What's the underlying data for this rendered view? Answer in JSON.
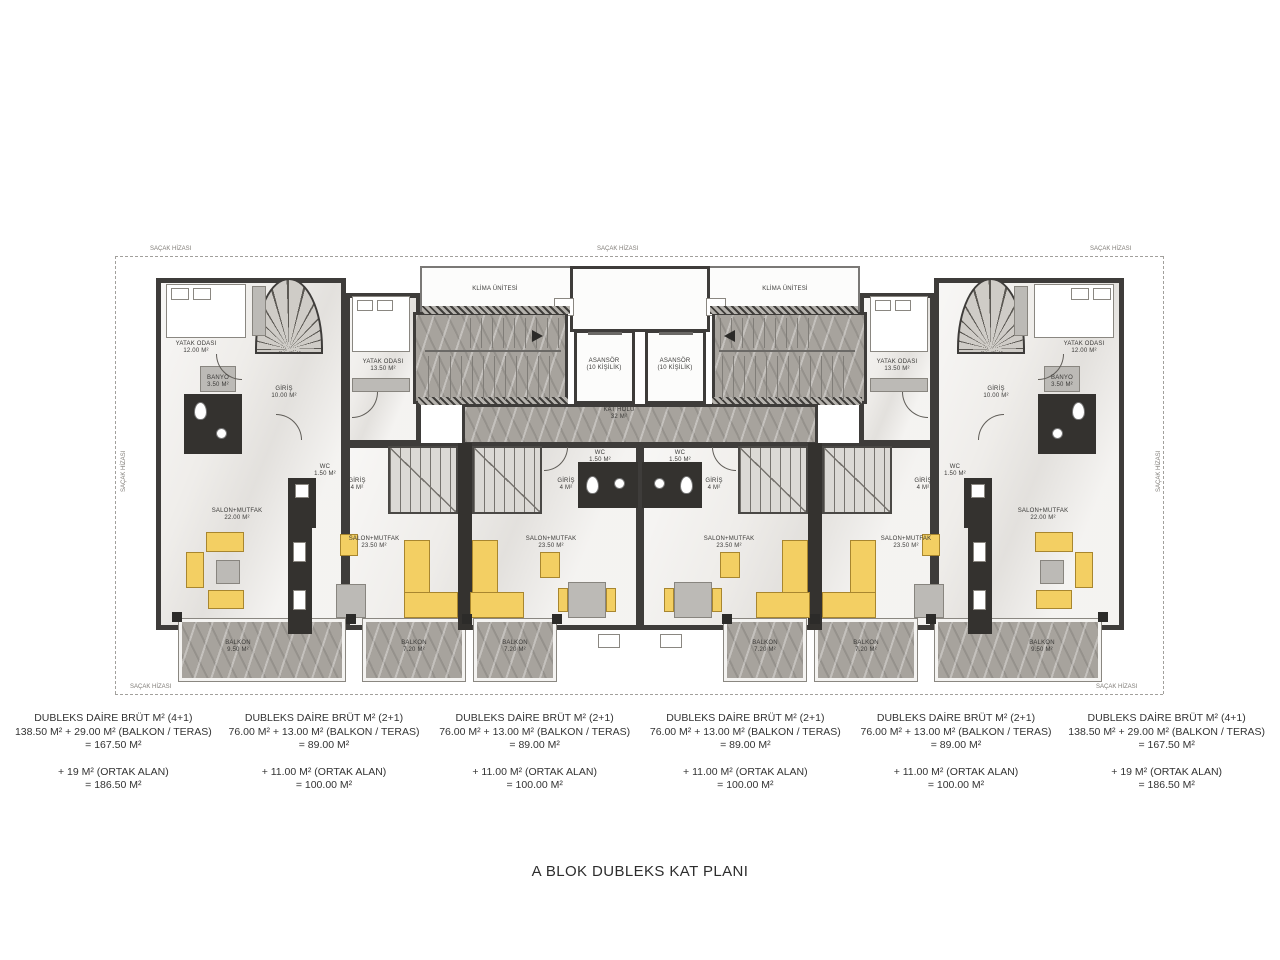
{
  "title": "A BLOK DUBLEKS KAT PLANI",
  "eave": {
    "label": "SAÇAK HİZASI",
    "positions": [
      {
        "x": 150,
        "y": 246,
        "rot": 0
      },
      {
        "x": 597,
        "y": 246,
        "rot": 0
      },
      {
        "x": 1090,
        "y": 246,
        "rot": 0
      },
      {
        "x": 121,
        "y": 492,
        "rot": -90
      },
      {
        "x": 1156,
        "y": 492,
        "rot": -90
      },
      {
        "x": 130,
        "y": 684,
        "rot": 0
      },
      {
        "x": 1096,
        "y": 684,
        "rot": 0
      }
    ]
  },
  "plan_labels": [
    {
      "id": "yatak-odasi-nw",
      "text": "YATAK ODASI",
      "sub": "12.00 M²",
      "x": 196,
      "y": 341
    },
    {
      "id": "yatak-odasi-2-left",
      "text": "YATAK ODASI",
      "sub": "13.50 M²",
      "x": 383,
      "y": 359
    },
    {
      "id": "banyo-left",
      "text": "BANYO",
      "sub": "3.50 M²",
      "x": 218,
      "y": 375
    },
    {
      "id": "giris-left",
      "text": "GİRİŞ",
      "sub": "10.00 M²",
      "x": 284,
      "y": 386
    },
    {
      "id": "klima-unitesi-left",
      "text": "KLİMA ÜNİTESİ",
      "sub": "",
      "x": 495,
      "y": 286
    },
    {
      "id": "klima-unitesi-right",
      "text": "KLİMA ÜNİTESİ",
      "sub": "",
      "x": 785,
      "y": 286
    },
    {
      "id": "asansor-left",
      "text": "ASANSÖR",
      "sub": "(10 KİŞİLİK)",
      "x": 604,
      "y": 358
    },
    {
      "id": "asansor-right",
      "text": "ASANSÖR",
      "sub": "(10 KİŞİLİK)",
      "x": 675,
      "y": 358
    },
    {
      "id": "kat-holu",
      "text": "KAT HOLÜ",
      "sub": "32 M²",
      "x": 619,
      "y": 407
    },
    {
      "id": "salon-unit1",
      "text": "SALON+MUTFAK",
      "sub": "22.00 M²",
      "x": 237,
      "y": 508
    },
    {
      "id": "salon-unit2",
      "text": "SALON+MUTFAK",
      "sub": "23.50 M²",
      "x": 374,
      "y": 536
    },
    {
      "id": "salon-unit3",
      "text": "SALON+MUTFAK",
      "sub": "23.50 M²",
      "x": 551,
      "y": 536
    },
    {
      "id": "salon-unit4",
      "text": "SALON+MUTFAK",
      "sub": "23.50 M²",
      "x": 729,
      "y": 536
    },
    {
      "id": "salon-unit5",
      "text": "SALON+MUTFAK",
      "sub": "23.50 M²",
      "x": 906,
      "y": 536
    },
    {
      "id": "salon-unit6",
      "text": "SALON+MUTFAK",
      "sub": "22.00 M²",
      "x": 1043,
      "y": 508
    },
    {
      "id": "giris-unit2",
      "text": "GİRİŞ",
      "sub": "4 M²",
      "x": 357,
      "y": 478
    },
    {
      "id": "giris-unit3",
      "text": "GİRİŞ",
      "sub": "4 M²",
      "x": 566,
      "y": 478
    },
    {
      "id": "giris-unit4",
      "text": "GİRİŞ",
      "sub": "4 M²",
      "x": 714,
      "y": 478
    },
    {
      "id": "giris-unit5",
      "text": "GİRİŞ",
      "sub": "4 M²",
      "x": 923,
      "y": 478
    },
    {
      "id": "wc-unit1",
      "text": "WC",
      "sub": "1.50 M²",
      "x": 325,
      "y": 464
    },
    {
      "id": "wc-unit3",
      "text": "WC",
      "sub": "1.50 M²",
      "x": 600,
      "y": 450
    },
    {
      "id": "wc-unit4",
      "text": "WC",
      "sub": "1.50 M²",
      "x": 680,
      "y": 450
    },
    {
      "id": "wc-unit6",
      "text": "WC",
      "sub": "1.50 M²",
      "x": 955,
      "y": 464
    },
    {
      "id": "yatak-odasi-2-right",
      "text": "YATAK ODASI",
      "sub": "13.50 M²",
      "x": 897,
      "y": 359
    },
    {
      "id": "yatak-odasi-ne",
      "text": "YATAK ODASI",
      "sub": "12.00 M²",
      "x": 1084,
      "y": 341
    },
    {
      "id": "banyo-right",
      "text": "BANYO",
      "sub": "3.50 M²",
      "x": 1062,
      "y": 375
    },
    {
      "id": "giris-right",
      "text": "GİRİŞ",
      "sub": "10.00 M²",
      "x": 996,
      "y": 386
    },
    {
      "id": "balkon-unit1",
      "text": "BALKON",
      "sub": "9.50 M²",
      "x": 238,
      "y": 640
    },
    {
      "id": "balkon-unit2",
      "text": "BALKON",
      "sub": "7.20 M²",
      "x": 414,
      "y": 640
    },
    {
      "id": "balkon-unit3",
      "text": "BALKON",
      "sub": "7.20 M²",
      "x": 515,
      "y": 640
    },
    {
      "id": "balkon-unit4",
      "text": "BALKON",
      "sub": "7.20 M²",
      "x": 765,
      "y": 640
    },
    {
      "id": "balkon-unit5",
      "text": "BALKON",
      "sub": "7.20 M²",
      "x": 866,
      "y": 640
    },
    {
      "id": "balkon-unit6",
      "text": "BALKON",
      "sub": "9.50 M²",
      "x": 1042,
      "y": 640
    }
  ],
  "legend": {
    "columns": [
      {
        "top": [
          "DUBLEKS DAİRE BRÜT M² (4+1)",
          "138.50 M² + 29.00 M² (BALKON / TERAS)",
          "= 167.50 M²"
        ],
        "bottom": [
          "+ 19 M² (ORTAK ALAN)",
          "= 186.50 M²"
        ]
      },
      {
        "top": [
          "DUBLEKS DAİRE BRÜT M² (2+1)",
          "76.00 M² + 13.00 M² (BALKON / TERAS)",
          "= 89.00 M²"
        ],
        "bottom": [
          "+ 11.00 M² (ORTAK ALAN)",
          "= 100.00 M²"
        ]
      },
      {
        "top": [
          "DUBLEKS DAİRE BRÜT M² (2+1)",
          "76.00 M² + 13.00 M² (BALKON / TERAS)",
          "= 89.00 M²"
        ],
        "bottom": [
          "+ 11.00 M² (ORTAK ALAN)",
          "= 100.00 M²"
        ]
      },
      {
        "top": [
          "DUBLEKS DAİRE BRÜT M² (2+1)",
          "76.00 M² + 13.00 M² (BALKON / TERAS)",
          "= 89.00 M²"
        ],
        "bottom": [
          "+ 11.00 M² (ORTAK ALAN)",
          "= 100.00 M²"
        ]
      },
      {
        "top": [
          "DUBLEKS DAİRE BRÜT M² (2+1)",
          "76.00 M² + 13.00 M² (BALKON / TERAS)",
          "= 89.00 M²"
        ],
        "bottom": [
          "+ 11.00 M² (ORTAK ALAN)",
          "= 100.00 M²"
        ]
      },
      {
        "top": [
          "DUBLEKS DAİRE BRÜT M² (4+1)",
          "138.50 M² + 29.00 M² (BALKON / TERAS)",
          "= 167.50 M²"
        ],
        "bottom": [
          "+ 19 M² (ORTAK ALAN)",
          "= 186.50 M²"
        ]
      }
    ]
  }
}
